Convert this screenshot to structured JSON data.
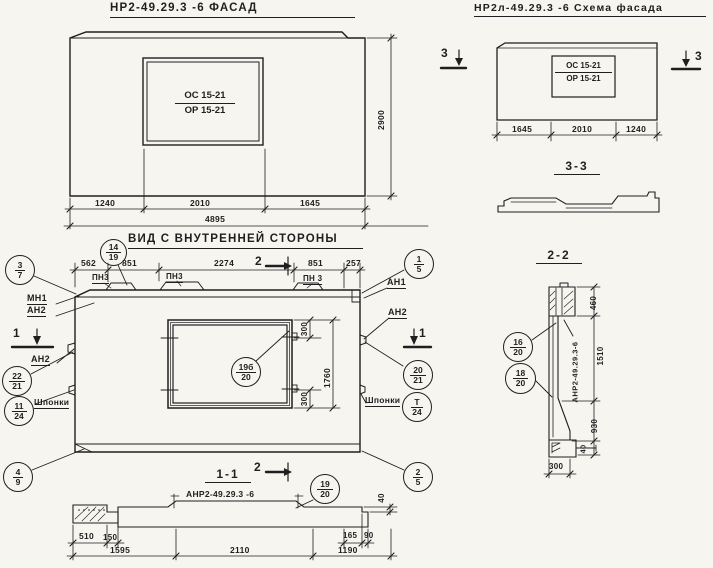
{
  "colors": {
    "ink": "#1f1f1f",
    "paper": "#f6f5f0"
  },
  "facade": {
    "title": "НР2-49.29.3 -6 ФАСАД",
    "window_mark": {
      "line1": "ОС 15-21",
      "line2": "ОР 15-21"
    },
    "dims": {
      "segments": [
        "1240",
        "2010",
        "1645"
      ],
      "total": "4895",
      "height": "2900"
    }
  },
  "schema": {
    "title": "НР2л-49.29.3 -6 Схема фасада",
    "window_mark": {
      "line1": "ОС 15-21",
      "line2": "ОР 15-21"
    },
    "dims": {
      "segments": [
        "1645",
        "2010",
        "1240"
      ]
    },
    "cut_left": "3",
    "cut_right": "3"
  },
  "section_3_3": {
    "title": "3-3"
  },
  "section_2_2": {
    "title": "2-2",
    "marking_vertical": "АНР2-49.29.3-6",
    "callouts": {
      "c16_20": [
        "16",
        "20"
      ],
      "c18_20": [
        "18",
        "20"
      ]
    },
    "dims": {
      "head": "460",
      "opening": "1510",
      "lower": "930",
      "toe": "40",
      "width": "300"
    }
  },
  "inner_view": {
    "title": "ВИД С ВНУТРЕННЕЙ СТОРОНЫ",
    "dims_top": [
      "562",
      "851",
      "2274",
      "851",
      "257"
    ],
    "embed_labels": [
      "ПН3",
      "ПН3",
      "ПН 3"
    ],
    "labels": {
      "mn1": "МН1",
      "an2_top_left": "АН2",
      "an1": "АН1",
      "an2_right": "АН2",
      "an2_left": "АН2",
      "keys_left": "Шпонки",
      "keys_right": "Шпонки"
    },
    "cut_1": "1",
    "cut_2": "2",
    "window_dims": {
      "top": "300",
      "bottom": "300",
      "height": "1760"
    },
    "callouts": {
      "c3_7": [
        "3",
        "7"
      ],
      "c14_19": [
        "14",
        "19"
      ],
      "c1_5": [
        "1",
        "5"
      ],
      "c22_21": [
        "22",
        "21"
      ],
      "c11_24": [
        "11",
        "24"
      ],
      "c20_21": [
        "20",
        "21"
      ],
      "cT_24": [
        "Т",
        "24"
      ],
      "c19b_20": [
        "19б",
        "20"
      ],
      "c4_9": [
        "4",
        "9"
      ],
      "c2_5": [
        "2",
        "5"
      ]
    }
  },
  "section_1_1": {
    "title": "1-1",
    "subtitle": "АНР2-49.29.3 -6",
    "callout_19_20": [
      "19",
      "20"
    ],
    "dims": {
      "row1": [
        "510",
        "150",
        "165",
        "90"
      ],
      "row2": [
        "1595",
        "2110",
        "1190"
      ],
      "toe": "40"
    }
  }
}
